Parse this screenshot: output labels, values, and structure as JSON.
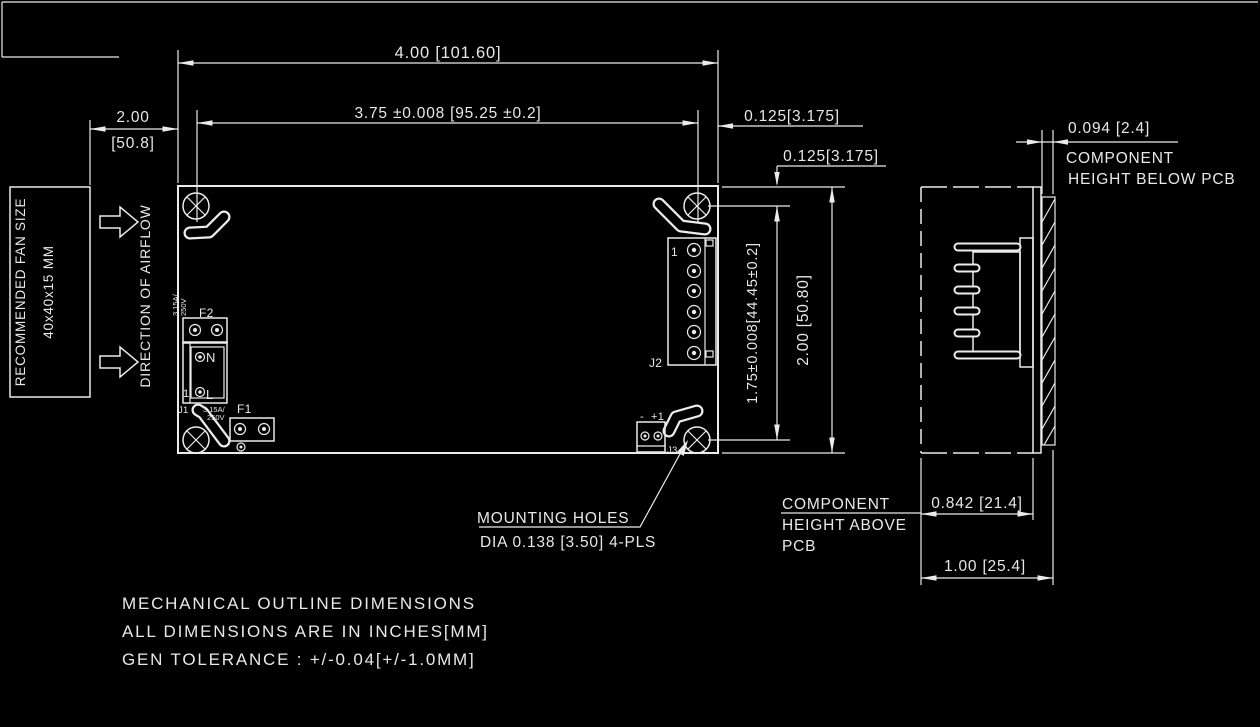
{
  "colors": {
    "background": "#000000",
    "line": "#ebebeb"
  },
  "main_view": {
    "dim_width_outer": "4.00 [101.60]",
    "dim_width_inner": "3.75 ±0.008 [95.25 ±0.2]",
    "dim_edge_offset_h": "0.125[3.175]",
    "dim_edge_offset_v": "0.125[3.175]",
    "dim_fan_clearance_line1": "2.00",
    "dim_fan_clearance_line2": "[50.8]",
    "dim_height_inner": "1.75±0.008[44.45±0.2]",
    "dim_height_outer": "2.00 [50.80]",
    "fan_box_line1": "RECOMMENDED FAN SIZE",
    "fan_box_line2": "40x40x15 MM",
    "airflow_label": "DIRECTION OF AIRFLOW",
    "mounting_note_line1": "MOUNTING HOLES",
    "mounting_note_line2": "DIA 0.138 [3.50] 4-PLS",
    "components": {
      "f1": "F1",
      "f2": "F2",
      "j1": "J1",
      "j2": "J2",
      "j3": "J3",
      "neutral": "N",
      "line": "L",
      "j2_pin1": "1",
      "j1_pin1": "1",
      "j3_minus": "-",
      "j3_plus": "+1",
      "fuse_rating_line1": "3.15A/",
      "fuse_rating_line2": "250V"
    }
  },
  "side_view": {
    "dim_below": "0.094 [2.4]",
    "below_label_line1": "COMPONENT",
    "below_label_line2": "HEIGHT BELOW PCB",
    "dim_above": "0.842 [21.4]",
    "above_label_line1": "COMPONENT",
    "above_label_line2": "HEIGHT ABOVE",
    "above_label_line3": "PCB",
    "dim_total": "1.00 [25.4]"
  },
  "notes": [
    "MECHANICAL OUTLINE DIMENSIONS",
    "ALL DIMENSIONS ARE IN INCHES[MM]",
    "GEN TOLERANCE : +/-0.04[+/-1.0MM]"
  ]
}
